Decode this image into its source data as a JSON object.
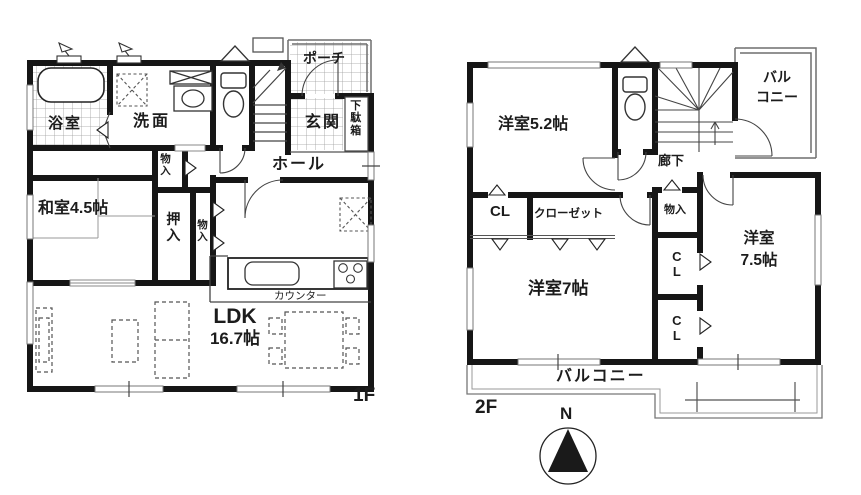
{
  "floor1": {
    "label": "1F",
    "rooms": {
      "bathroom": "浴室",
      "washroom": "洗面",
      "porch": "ポーチ",
      "entrance": "玄関",
      "shoe_cabinet": "下駄箱",
      "hall": "ホール",
      "hall_storage": "物入",
      "japanese_room": "和室4.5帖",
      "oshiire": "押入",
      "storage": "物入",
      "counter": "カウンター",
      "ldk_name": "LDK",
      "ldk_size": "16.7帖"
    }
  },
  "floor2": {
    "label": "2F",
    "rooms": {
      "bedroom_52": "洋室5.2帖",
      "balcony_top_1": "バル",
      "balcony_top_2": "コニー",
      "corridor": "廊下",
      "closet_cl": "CL",
      "closet": "クローゼット",
      "storage": "物入",
      "bedroom_7": "洋室7帖",
      "closet_cl2": "CL",
      "closet_cl3": "CL",
      "bedroom_75_1": "洋室",
      "bedroom_75_2": "7.5帖",
      "balcony_bottom": "バルコニー"
    }
  },
  "compass": {
    "north": "N"
  },
  "colors": {
    "wall": "#161616",
    "thin_line": "#6e6e6e",
    "text": "#1c1c1c"
  }
}
